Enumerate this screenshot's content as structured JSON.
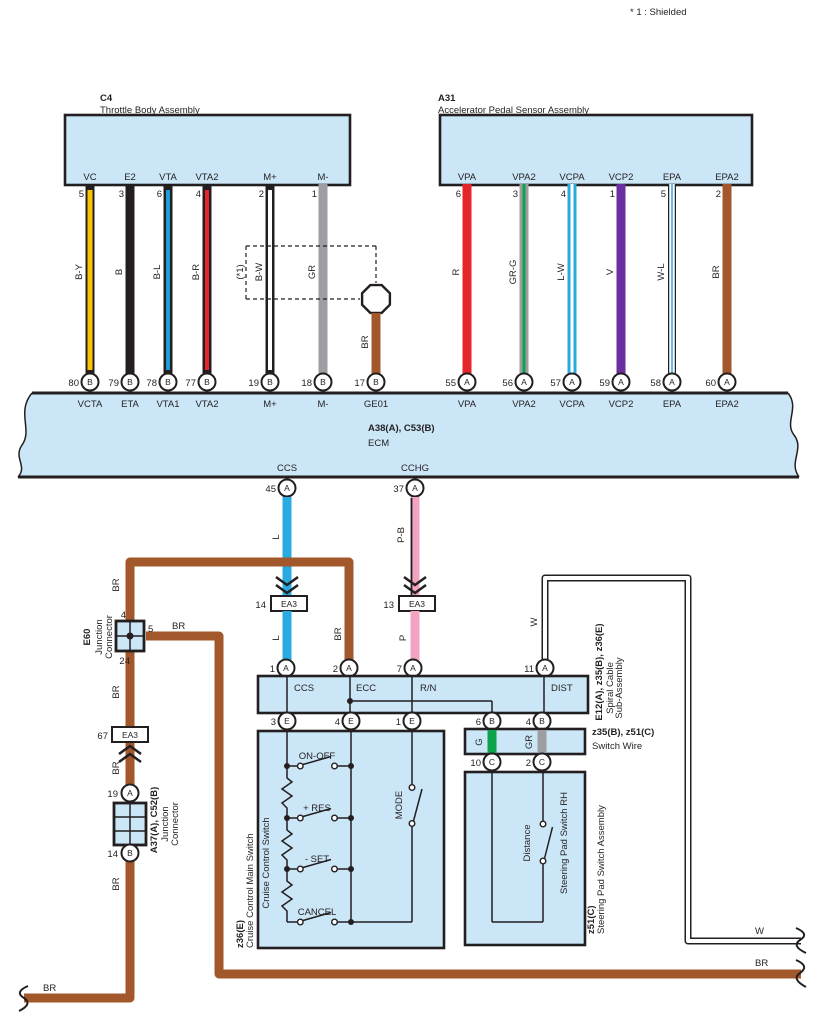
{
  "note": "* 1 : Shielded",
  "labels": {
    "br": "BR",
    "w": "W",
    "l": "L",
    "p": "P",
    "pb": "P-B",
    "g": "G",
    "gr": "GR",
    "shield": "(*1)"
  },
  "c4": {
    "id": "C4",
    "name": "Throttle Body Assembly",
    "pins": [
      {
        "pin": "VC",
        "num": "5",
        "wire": "B-Y",
        "ecm_num": "80",
        "ecm_letter": "B",
        "ecm_name": "VCTA"
      },
      {
        "pin": "E2",
        "num": "3",
        "wire": "B",
        "ecm_num": "79",
        "ecm_letter": "B",
        "ecm_name": "ETA"
      },
      {
        "pin": "VTA",
        "num": "6",
        "wire": "B-L",
        "ecm_num": "78",
        "ecm_letter": "B",
        "ecm_name": "VTA1"
      },
      {
        "pin": "VTA2",
        "num": "4",
        "wire": "B-R",
        "ecm_num": "77",
        "ecm_letter": "B",
        "ecm_name": "VTA2"
      },
      {
        "pin": "M+",
        "num": "2",
        "wire": "B-W",
        "ecm_num": "19",
        "ecm_letter": "B",
        "ecm_name": "M+"
      },
      {
        "pin": "M-",
        "num": "1",
        "wire": "GR",
        "ecm_num": "18",
        "ecm_letter": "B",
        "ecm_name": "M-"
      }
    ],
    "drain": {
      "wire": "BR",
      "ecm_num": "17",
      "ecm_letter": "B",
      "ecm_name": "GE01"
    }
  },
  "a31": {
    "id": "A31",
    "name": "Accelerator Pedal Sensor Assembly",
    "pins": [
      {
        "pin": "VPA",
        "num": "6",
        "wire": "R",
        "ecm_num": "55",
        "ecm_letter": "A",
        "ecm_name": "VPA"
      },
      {
        "pin": "VPA2",
        "num": "3",
        "wire": "GR-G",
        "ecm_num": "56",
        "ecm_letter": "A",
        "ecm_name": "VPA2"
      },
      {
        "pin": "VCPA",
        "num": "4",
        "wire": "L-W",
        "ecm_num": "57",
        "ecm_letter": "A",
        "ecm_name": "VCPA"
      },
      {
        "pin": "VCP2",
        "num": "1",
        "wire": "V",
        "ecm_num": "59",
        "ecm_letter": "A",
        "ecm_name": "VCP2"
      },
      {
        "pin": "EPA",
        "num": "5",
        "wire": "W-L",
        "ecm_num": "58",
        "ecm_letter": "A",
        "ecm_name": "EPA"
      },
      {
        "pin": "EPA2",
        "num": "2",
        "wire": "BR",
        "ecm_num": "60",
        "ecm_letter": "A",
        "ecm_name": "EPA2"
      }
    ]
  },
  "ecm": {
    "id": "A38(A), C53(B)",
    "name": "ECM",
    "ccs": {
      "name": "CCS",
      "num": "45",
      "letter": "A"
    },
    "cchg": {
      "name": "CCHG",
      "num": "37",
      "letter": "A"
    }
  },
  "ea3_14": {
    "num": "14",
    "label": "EA3"
  },
  "ea3_13": {
    "num": "13",
    "label": "EA3"
  },
  "ea3_67": {
    "num": "67",
    "label": "EA3"
  },
  "e60": {
    "id": "E60",
    "name1": "Junction",
    "name2": "Connector",
    "pin_top": "4",
    "pin_right": "5",
    "pin_bottom": "24"
  },
  "a37": {
    "id": "A37(A), C52(B)",
    "name1": "Junction",
    "name2": "Connector",
    "top_num": "19",
    "top_letter": "A",
    "bottom_num": "14",
    "bottom_letter": "B"
  },
  "spiral": {
    "id": "E12(A), z35(B), z36(E)",
    "name1": "Spiral Cable",
    "name2": "Sub-Assembly",
    "top_pins": [
      {
        "num": "1",
        "letter": "A",
        "label": "CCS"
      },
      {
        "num": "2",
        "letter": "A",
        "label": "ECC"
      },
      {
        "num": "7",
        "letter": "A",
        "label": "R/N"
      },
      {
        "num": "11",
        "letter": "A",
        "label": "DIST"
      }
    ],
    "bottom_pins": [
      {
        "num": "3",
        "letter": "E"
      },
      {
        "num": "4",
        "letter": "E"
      },
      {
        "num": "1",
        "letter": "E"
      },
      {
        "num": "6",
        "letter": "B"
      },
      {
        "num": "4",
        "letter": "B"
      }
    ]
  },
  "switch_wire": {
    "id": "z35(B), z51(C)",
    "name": "Switch Wire",
    "g": "G",
    "gr": "GR",
    "bottom_pins": [
      {
        "num": "10",
        "letter": "C"
      },
      {
        "num": "2",
        "letter": "C"
      }
    ]
  },
  "cruise": {
    "id": "z36(E)",
    "name": "Cruise Control Main Switch",
    "inner": "Cruise Control Switch",
    "sw1": "ON-OFF",
    "sw2": "+ RES",
    "sw3": "- SET",
    "sw4": "CANCEL",
    "mode": "MODE"
  },
  "steering": {
    "id": "z51(C)",
    "name": "Steering Pad Switch Assembly",
    "inner": "Steering Pad Switch RH",
    "switch": "Distance"
  },
  "colors": {
    "block_fill": "#CBE6F7",
    "brown": "#A3582B",
    "light_blue": "#29ABE2",
    "pink": "#F2A2C2",
    "red": "#E5252A",
    "yellow": "#F7C600",
    "gray": "#9C9EA1",
    "green": "#0EA24C",
    "violet": "#6B2E9E",
    "blue": "#1E9CD7",
    "black": "#231F20"
  }
}
